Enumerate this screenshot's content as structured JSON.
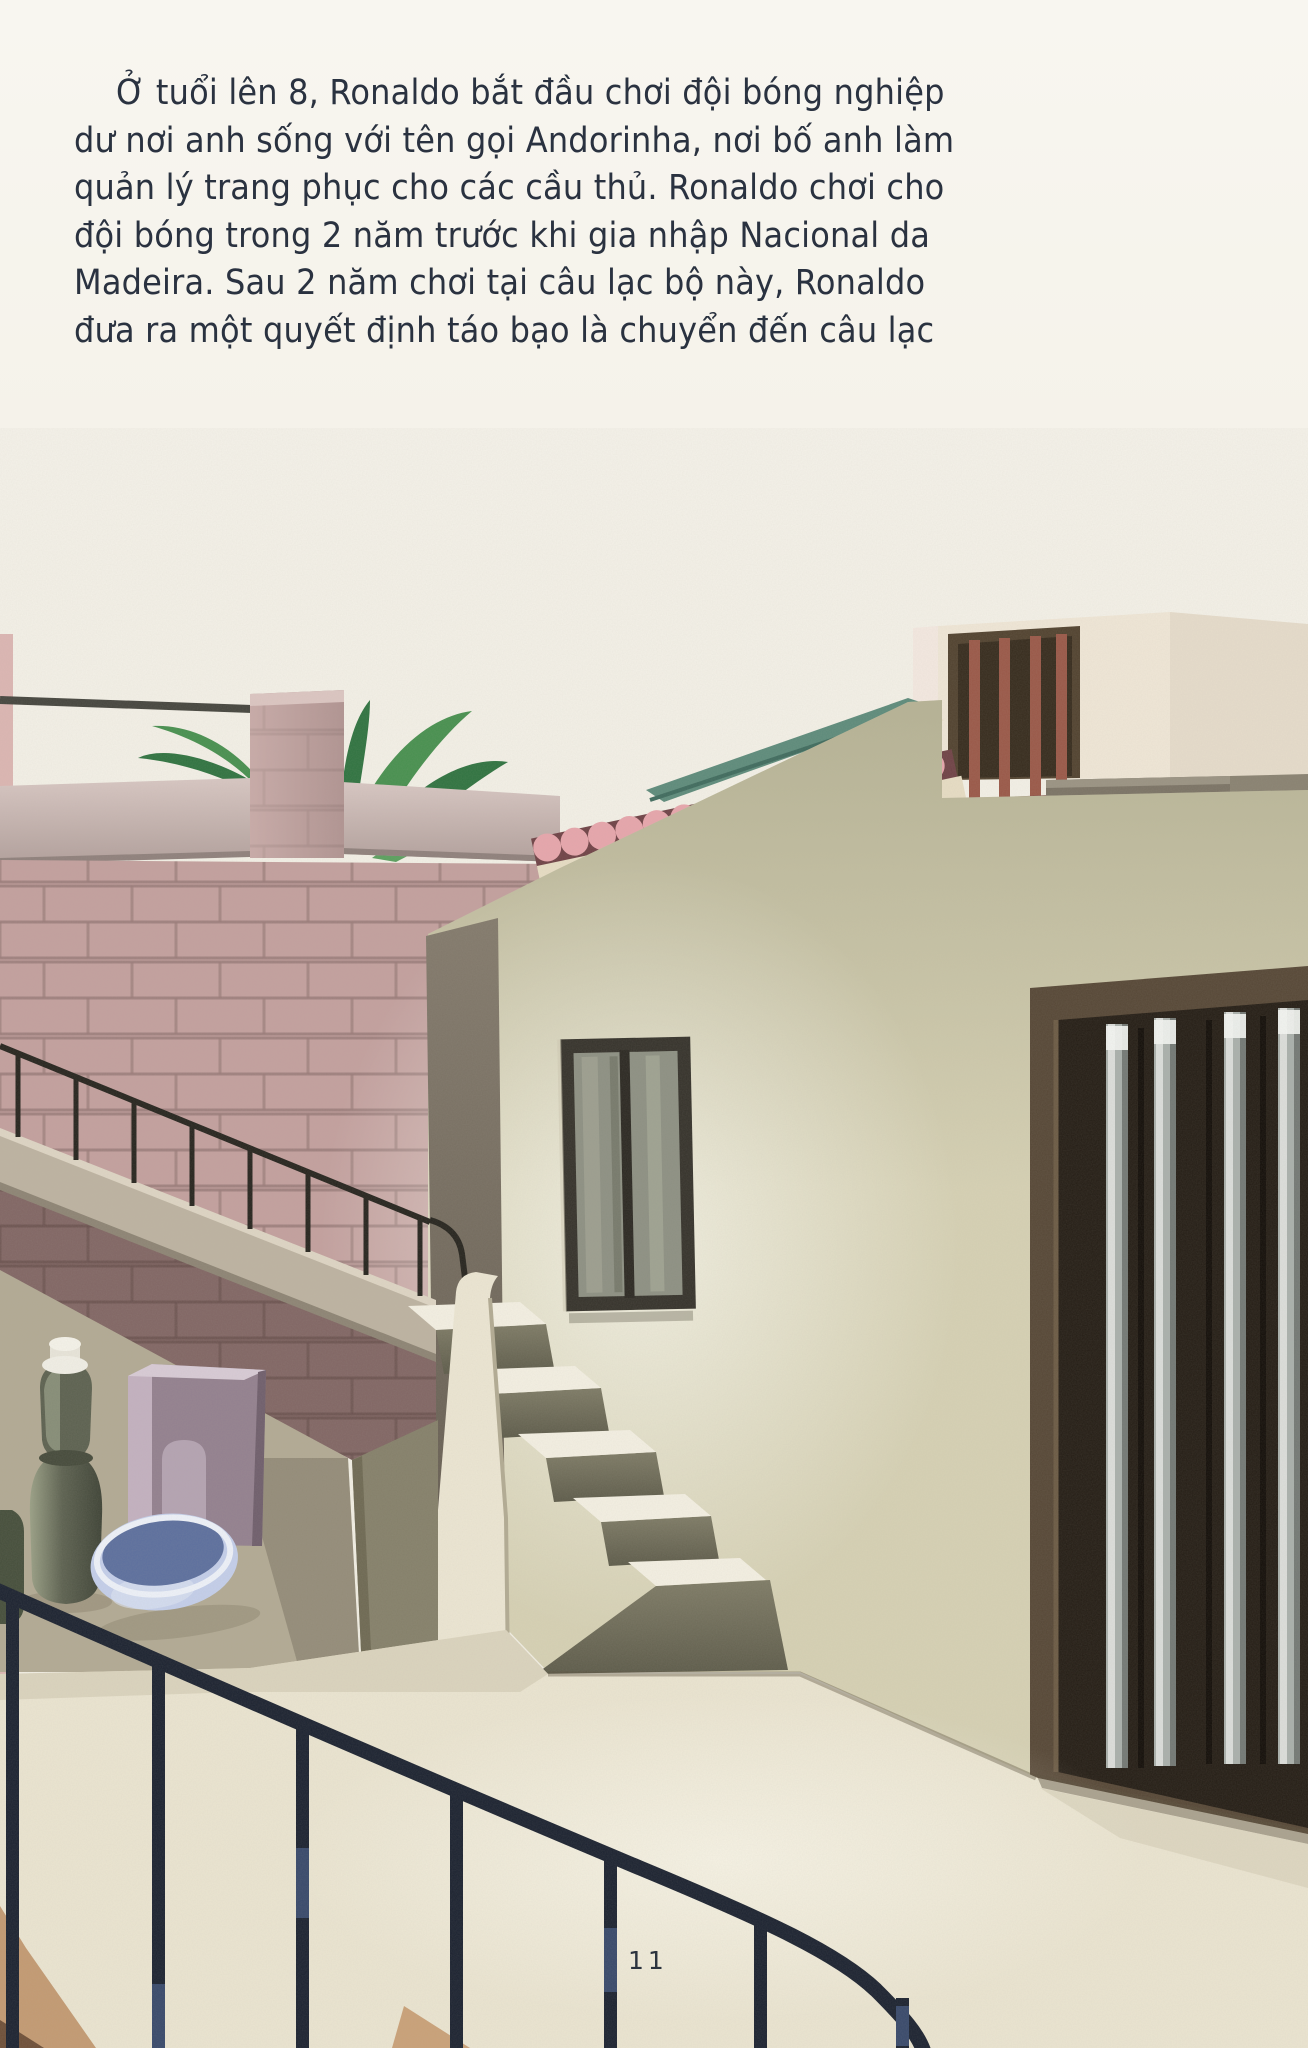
{
  "page": {
    "number": "11",
    "paragraph": {
      "lines": [
        "Ở tuổi lên 8, Ronaldo bắt đầu chơi đội bóng nghiệp",
        "dư nơi anh sống với tên gọi Andorinha, nơi bố anh làm",
        "quản lý trang phục cho các cầu thủ. Ronaldo chơi cho",
        "đội bóng trong 2 năm trước khi gia nhập Nacional da",
        "Madeira. Sau 2 năm chơi tại câu lạc bộ này, Ronaldo",
        "đưa ra một quyết định táo bạo là chuyển đến câu lạc"
      ]
    }
  },
  "illustration": {
    "name": "house-courtyard-with-exterior-staircase",
    "colors": {
      "paper": "#f5f2e9",
      "ink": "#2a3240",
      "brick": "#c3a09e",
      "mortar": "#9a7b79",
      "leaf": "#47904f",
      "leaf_dark": "#2f7340",
      "leaf_light": "#5aa05e",
      "tile_pink": "#e7a6ac",
      "tile_gap": "#6f4246",
      "roof_teal": "#5d8b7b",
      "roof_cream": "#e9dfc8",
      "stucco": "#d6d1b4",
      "door_frame": "#564736",
      "door_dark": "#241d15",
      "bar_metal": "#aab0ac",
      "bar_red": "#9a5848",
      "stair_tread": "#f4f0e3",
      "stair_riser": "#6f6c58",
      "fence": "#1b2230",
      "walkway": "#ebe5d1",
      "ground": "#b2aa94",
      "basin_light": "#c4cfeb",
      "basin_dark": "#5c6f9e",
      "bottle": "#5c6150",
      "cabinet": "#93808f"
    }
  }
}
